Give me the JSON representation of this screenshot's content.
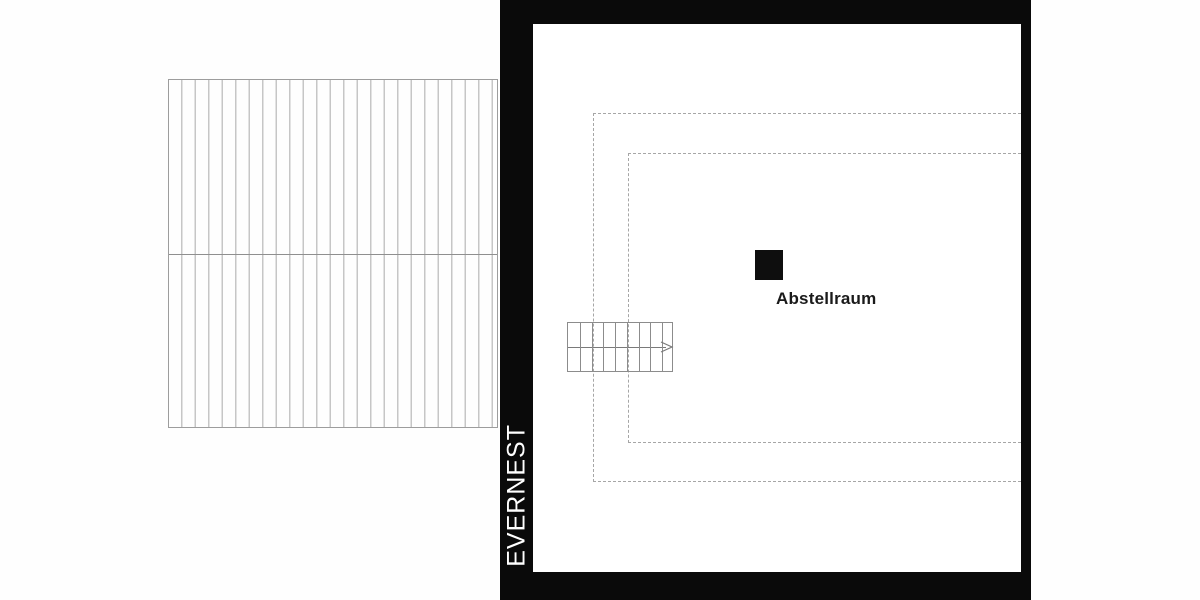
{
  "brand": {
    "name": "EVERNEST",
    "text_color": "#ffffff",
    "bar_color": "#0a0a0a"
  },
  "plan": {
    "room": {
      "label": "Abstellraum",
      "marker_color": "#0e0e0e"
    },
    "stair": {
      "steps": 9,
      "direction_icon": "right-arrow"
    },
    "lines": {
      "solid": "#8c8c8c",
      "dashed": "#a6a6a6",
      "hatch": "#c6c6c6",
      "roof_border": "#9d9d9d"
    }
  }
}
